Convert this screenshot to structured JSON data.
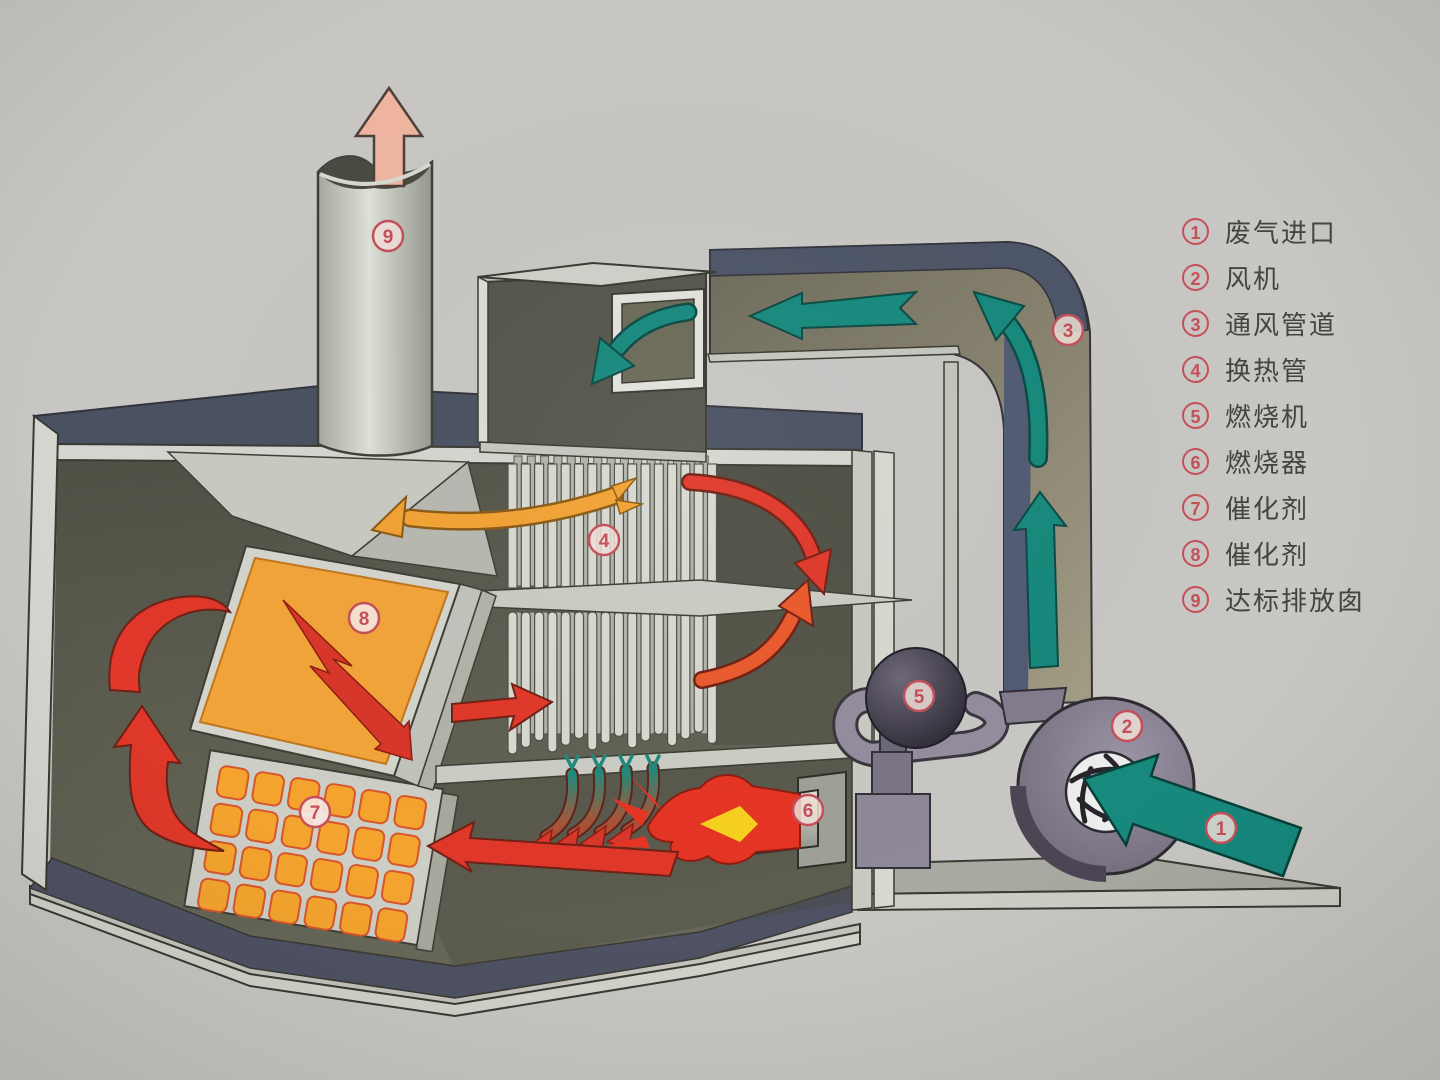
{
  "legend": {
    "items": [
      {
        "num": "1",
        "label": "废气进口"
      },
      {
        "num": "2",
        "label": "风机"
      },
      {
        "num": "3",
        "label": "通风管道"
      },
      {
        "num": "4",
        "label": "换热管"
      },
      {
        "num": "5",
        "label": "燃烧机"
      },
      {
        "num": "6",
        "label": "燃烧器"
      },
      {
        "num": "7",
        "label": "催化剂"
      },
      {
        "num": "8",
        "label": "催化剂"
      },
      {
        "num": "9",
        "label": "达标排放囱"
      }
    ]
  },
  "colors": {
    "badge_red": "#c4505a",
    "flow_teal": "#17897d",
    "flow_red": "#e0382a",
    "panel_orange": "#f2a439",
    "exhaust_pink": "#efb5a0",
    "duct_slate": "#4d5568",
    "duct_khaki": "#8b8672",
    "fan_purple": "#8a8292",
    "legend_text": "#45453f"
  }
}
